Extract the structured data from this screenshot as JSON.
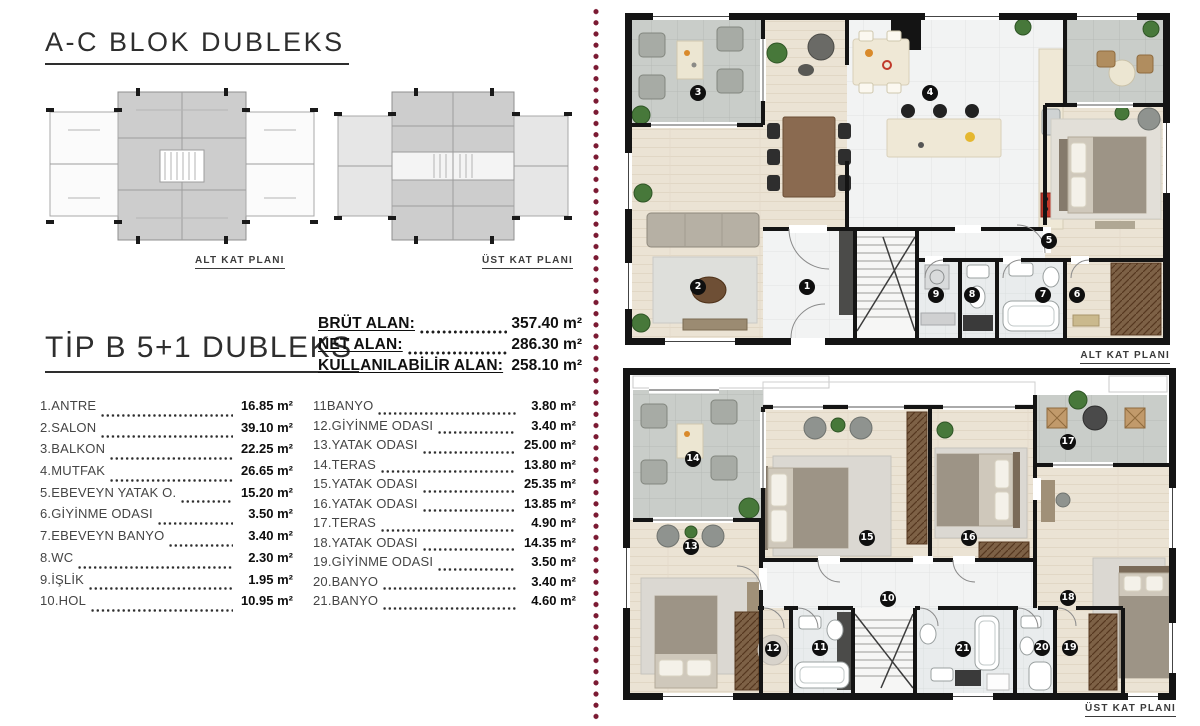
{
  "page": {
    "title": "A-C BLOK DUBLEKS",
    "subtitle": "TİP B 5+1 DUBLEKS"
  },
  "thumbnails": [
    {
      "caption": "ALT KAT  PLANI"
    },
    {
      "caption": "ÜST KAT  PLANI"
    }
  ],
  "areas": [
    {
      "label": "BRÜT ALAN:",
      "value": "357.40 m²"
    },
    {
      "label": "NET ALAN:",
      "value": "286.30 m²"
    },
    {
      "label": "KULLANILABİLİR ALAN:",
      "value": "258.10 m²"
    }
  ],
  "room_list": {
    "left": [
      {
        "name": "1.ANTRE",
        "area": "16.85 m²"
      },
      {
        "name": "2.SALON",
        "area": "39.10 m²"
      },
      {
        "name": "3.BALKON",
        "area": "22.25 m²"
      },
      {
        "name": "4.MUTFAK",
        "area": "26.65 m²"
      },
      {
        "name": "5.EBEVEYN YATAK O.",
        "area": "15.20 m²"
      },
      {
        "name": "6.GİYİNME ODASI",
        "area": "3.50 m²"
      },
      {
        "name": "7.EBEVEYN BANYO",
        "area": "3.40 m²"
      },
      {
        "name": "8.WC",
        "area": "2.30 m²"
      },
      {
        "name": "9.İŞLİK",
        "area": "1.95 m²"
      },
      {
        "name": "10.HOL",
        "area": "10.95 m²"
      }
    ],
    "right": [
      {
        "name": "11BANYO",
        "area": "3.80 m²"
      },
      {
        "name": "12.GİYİNME ODASI",
        "area": "3.40 m²"
      },
      {
        "name": "13.YATAK ODASI",
        "area": "25.00 m²"
      },
      {
        "name": "14.TERAS",
        "area": "13.80 m²"
      },
      {
        "name": "15.YATAK ODASI",
        "area": "25.35 m²"
      },
      {
        "name": "16.YATAK ODASI",
        "area": "13.85 m²"
      },
      {
        "name": "17.TERAS",
        "area": "4.90 m²"
      },
      {
        "name": "18.YATAK ODASI",
        "area": "14.35 m²"
      },
      {
        "name": "19.GİYİNME ODASI",
        "area": "3.50 m²"
      },
      {
        "name": "20.BANYO",
        "area": "3.40 m²"
      },
      {
        "name": "21.BANYO",
        "area": "4.60 m²"
      }
    ]
  },
  "plans": [
    {
      "id": "plan-alt",
      "caption": "ALT KAT  PLANI",
      "markers": [
        {
          "n": "3",
          "x": 73,
          "y": 80
        },
        {
          "n": "4",
          "x": 305,
          "y": 80
        },
        {
          "n": "2",
          "x": 73,
          "y": 274
        },
        {
          "n": "1",
          "x": 182,
          "y": 274
        },
        {
          "n": "9",
          "x": 311,
          "y": 282
        },
        {
          "n": "8",
          "x": 347,
          "y": 282
        },
        {
          "n": "7",
          "x": 418,
          "y": 282
        },
        {
          "n": "6",
          "x": 452,
          "y": 282
        },
        {
          "n": "5",
          "x": 424,
          "y": 228
        }
      ]
    },
    {
      "id": "plan-ust",
      "caption": "ÜST KAT  PLANI",
      "markers": [
        {
          "n": "14",
          "x": 70,
          "y": 91
        },
        {
          "n": "17",
          "x": 445,
          "y": 74
        },
        {
          "n": "13",
          "x": 68,
          "y": 179
        },
        {
          "n": "15",
          "x": 244,
          "y": 170
        },
        {
          "n": "16",
          "x": 346,
          "y": 170
        },
        {
          "n": "10",
          "x": 265,
          "y": 231
        },
        {
          "n": "18",
          "x": 445,
          "y": 230
        },
        {
          "n": "12",
          "x": 150,
          "y": 281
        },
        {
          "n": "11",
          "x": 197,
          "y": 280
        },
        {
          "n": "21",
          "x": 340,
          "y": 281
        },
        {
          "n": "20",
          "x": 419,
          "y": 280
        },
        {
          "n": "19",
          "x": 447,
          "y": 280
        }
      ]
    }
  ],
  "colors": {
    "divider_dot": "#7b1a33",
    "wall": "#141414",
    "tile": "#c9cdc9",
    "wood": "#ebe3d4",
    "marble": "#f2f3f3",
    "accent_red": "#c0392b"
  }
}
